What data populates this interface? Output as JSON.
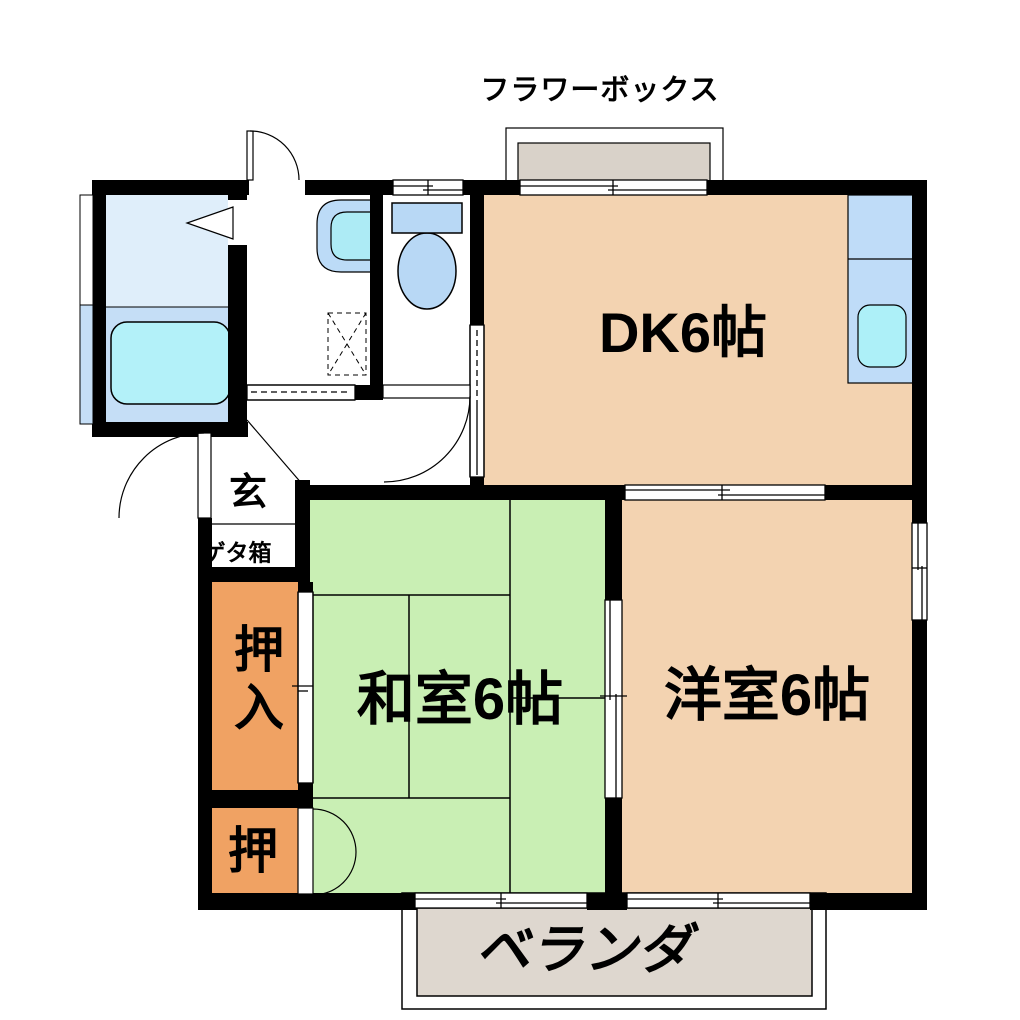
{
  "floorplan": {
    "flower_box": {
      "label": "フラワーボックス"
    },
    "dk": {
      "label": "DK6帖"
    },
    "washitsu": {
      "label": "和室6帖"
    },
    "youshitsu": {
      "label": "洋室6帖"
    },
    "oshiire": {
      "label": "押入"
    },
    "oshi": {
      "label": "押"
    },
    "genkan": {
      "label": "玄"
    },
    "getabako": {
      "label": "ゲタ箱"
    },
    "veranda": {
      "label": "ベランダ"
    },
    "colors": {
      "room_peach": "#f3d3b1",
      "tatami_green": "#c9efb4",
      "closet_orange": "#f0a263",
      "veranda_gray": "#ded7cf",
      "flower_box_gray": "#d9d2c9",
      "bath_floor": "#dfeefa",
      "bath_lower": "#c5def6",
      "bathtub_cyan": "#b3f1f9",
      "fixture_blue": "#b8d8f5",
      "sink_cyan": "#adf0f8",
      "counter_blue": "#bfdcf8",
      "wall_black": "#000000"
    }
  }
}
